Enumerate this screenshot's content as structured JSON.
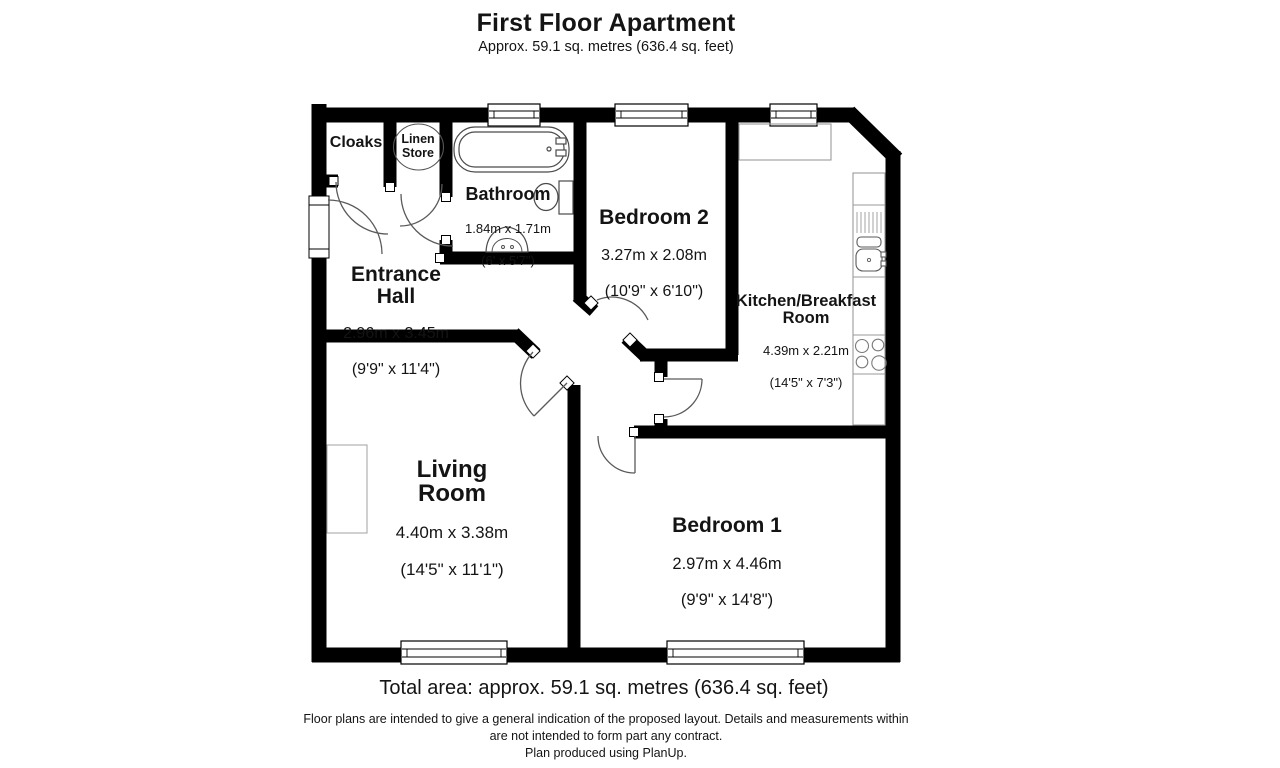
{
  "title": "First Floor Apartment",
  "subtitle": "Approx. 59.1 sq. metres (636.4 sq. feet)",
  "rooms": {
    "cloaks": {
      "name": "Cloaks"
    },
    "linen_store": {
      "name": "Linen\nStore"
    },
    "bathroom": {
      "name": "Bathroom",
      "metric": "1.84m x 1.71m",
      "imperial": "(6' x 5'7\")"
    },
    "entrance_hall": {
      "name": "Entrance\nHall",
      "metric": "2.96m x 3.45m",
      "imperial": "(9'9\" x 11'4\")"
    },
    "bedroom2": {
      "name": "Bedroom 2",
      "metric": "3.27m x 2.08m",
      "imperial": "(10'9\" x 6'10\")"
    },
    "kitchen": {
      "name": "Kitchen/Breakfast\nRoom",
      "metric": "4.39m x 2.21m",
      "imperial": "(14'5\" x 7'3\")"
    },
    "living_room": {
      "name": "Living\nRoom",
      "metric": "4.40m x 3.38m",
      "imperial": "(14'5\" x 11'1\")"
    },
    "bedroom1": {
      "name": "Bedroom 1",
      "metric": "2.97m x 4.46m",
      "imperial": "(9'9\" x 14'8\")"
    }
  },
  "footer": {
    "total_area": "Total area: approx. 59.1 sq. metres (636.4 sq. feet)",
    "disclaimer": "Floor plans are intended to give a general indication of the proposed layout. Details and measurements within\nare not intended to form part any contract.",
    "credit": "Plan produced using PlanUp."
  },
  "colors": {
    "wall": "#000000",
    "fixture": "#4a4a4a",
    "counter": "#9a9a9a",
    "text": "#141414"
  }
}
